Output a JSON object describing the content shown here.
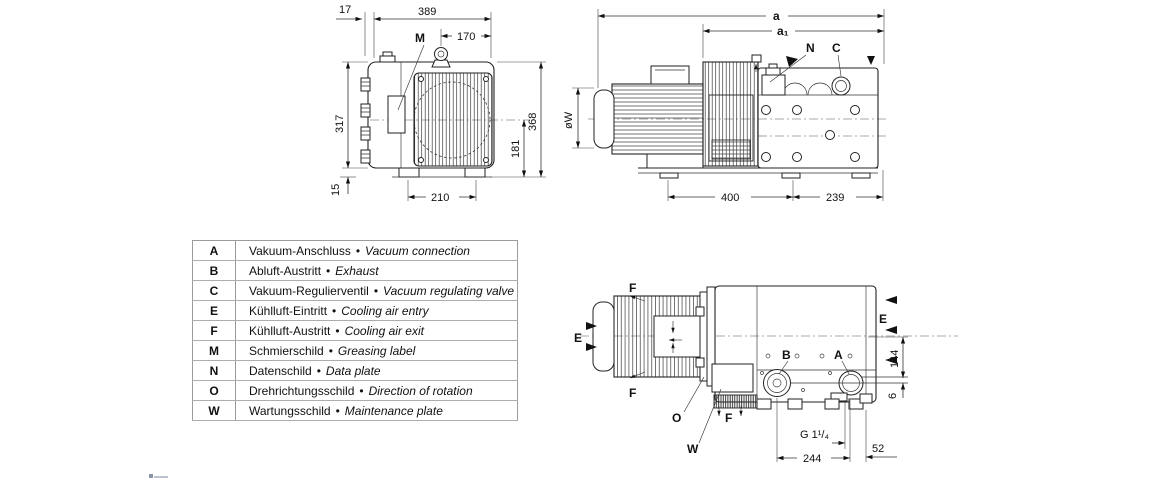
{
  "colors": {
    "ink": "#111111",
    "line": "#222222",
    "table_border": "#9c9c9c",
    "background": "#ffffff"
  },
  "front_view": {
    "labels": {
      "m": "M"
    },
    "dims": {
      "offset_17": "17",
      "width_389": "389",
      "eye_170": "170",
      "height_317": "317",
      "foot_15": "15",
      "height_368": "368",
      "axis_181": "181",
      "feet_210": "210"
    }
  },
  "side_view": {
    "labels": {
      "n": "N",
      "c": "C"
    },
    "dims": {
      "overall_a": "a",
      "pump_a1": "a₁",
      "motor_dia": "øW",
      "body_400": "400",
      "rear_239": "239"
    }
  },
  "top_view": {
    "labels": {
      "f_top": "F",
      "f_bottom": "F",
      "f_exhaust": "F",
      "e_left": "E",
      "e_right": "E",
      "o": "O",
      "w": "W",
      "b": "B",
      "a": "A"
    },
    "dims": {
      "thread_g114": "G 1¹/₄",
      "span_244": "244",
      "edge_52": "52",
      "height_144": "144",
      "offset_6": "6"
    }
  },
  "legend": {
    "bullet": "•",
    "rows": [
      {
        "key": "A",
        "de": "Vakuum-Anschluss",
        "en": "Vacuum connection"
      },
      {
        "key": "B",
        "de": "Abluft-Austritt",
        "en": "Exhaust"
      },
      {
        "key": "C",
        "de": "Vakuum-Regulierventil",
        "en": "Vacuum regulating valve"
      },
      {
        "key": "E",
        "de": "Kühlluft-Eintritt",
        "en": "Cooling air entry"
      },
      {
        "key": "F",
        "de": "Kühlluft-Austritt",
        "en": "Cooling air exit"
      },
      {
        "key": "M",
        "de": "Schmierschild",
        "en": "Greasing label"
      },
      {
        "key": "N",
        "de": "Datenschild",
        "en": "Data plate"
      },
      {
        "key": "O",
        "de": "Drehrichtungsschild",
        "en": "Direction of rotation"
      },
      {
        "key": "W",
        "de": "Wartungsschild",
        "en": "Maintenance plate"
      }
    ]
  }
}
